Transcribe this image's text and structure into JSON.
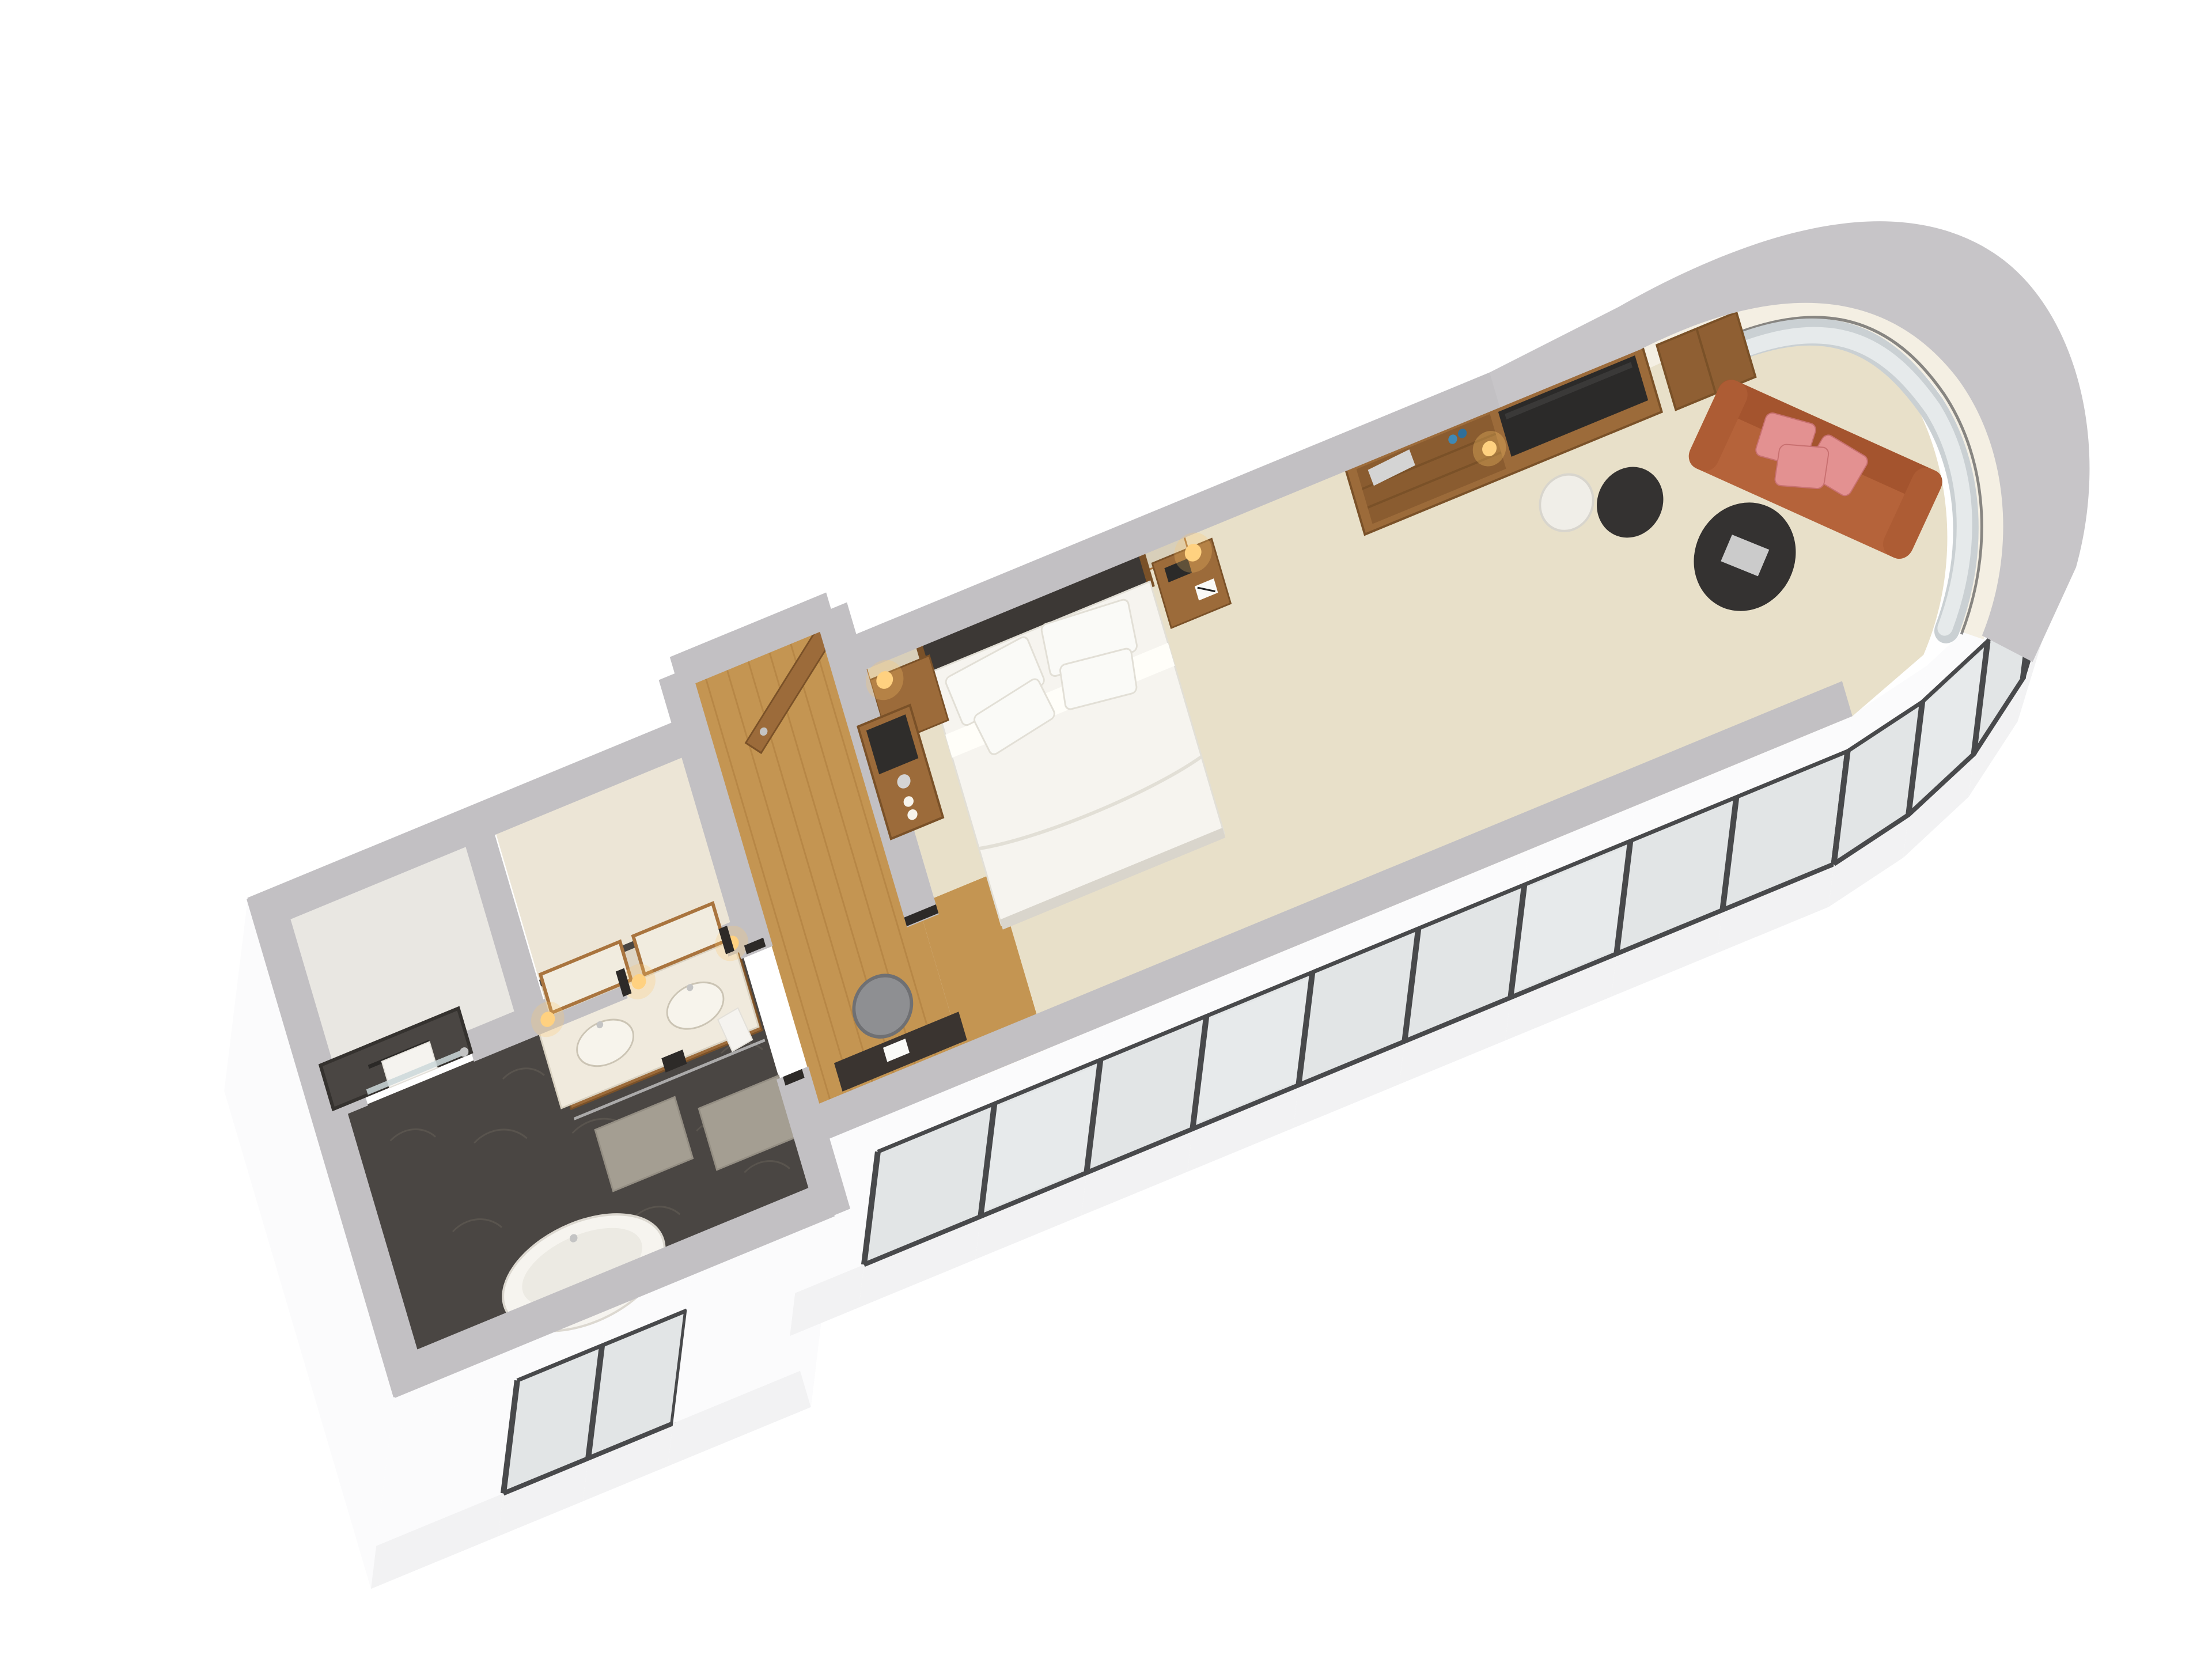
{
  "meta": {
    "type": "3d-floorplan-render",
    "view": "isometric-cutaway"
  },
  "colors": {
    "background": "#ffffff",
    "wall_cut_gray": "#c2c0c3",
    "wall_cut_gray_light": "#c7c5c8",
    "interior_wall_face": "#f4efe3",
    "facade_white": "#fbfbfc",
    "facade_shade": "#f2f2f3",
    "glass": "#e2e5e6",
    "glass_frame": "#48494b",
    "sheer_curtain": "#ebeeef",
    "drape_curtain": "#cad0d3",
    "curtain_rod": "#3e3e40",
    "carpet": "#e8e0c9",
    "wood_floor": "#c49552",
    "wood_plank_line": "#ad7c3e",
    "wood_furniture": "#9c6b3a",
    "wood_furniture_dark": "#7a5128",
    "wood_frame": "#a9743e",
    "tile_dark": "#4a4643",
    "tile_pattern": "#605a53",
    "shower_floor": "#e9e7e2",
    "toilet_floor": "#ece5d6",
    "beige_panel": "#ded5c4",
    "panel_trim_dark": "#4a4642",
    "marble": "#f0eadd",
    "sink_white": "#f7f4ec",
    "bed_white": "#f6f4ef",
    "pillow_white": "#fafaf7",
    "linen_shadow": "#e2dfd6",
    "headboard_dark": "#3c3835",
    "sofa_terracotta": "#b5633a",
    "sofa_terracotta_dark": "#a4542e",
    "pillow_pink": "#e39191",
    "pillow_pink_dark": "#c87070",
    "table_black": "#343231",
    "table_white": "#f0eee8",
    "tray_silver": "#d4d4d4",
    "lamp_glow": "#ffd180",
    "lamp_halo": "#ffc96a",
    "towel_white": "#f5f3ef",
    "mat_gray": "#a49e92",
    "chair_gray": "#8e8f92",
    "desk_dark": "#3a3430",
    "tv_black": "#2b2a29",
    "metal_silver": "#c4c4c4",
    "door_jamb_dark": "#2d2a28",
    "bottle_blue": "#3f89b5"
  },
  "scene_items": [
    "exterior-cut-walls",
    "window-facade",
    "curved-window-wall",
    "shower-room",
    "toilet-room",
    "bathroom",
    "double-vanity",
    "vanity-mirrors",
    "vanity-sconces",
    "bathtub",
    "bath-mats",
    "towel-rail",
    "entry-hall",
    "entry-door",
    "minibar-niche",
    "desk",
    "desk-chair",
    "bedroom",
    "double-bed",
    "bed-pillows",
    "headboard",
    "nightstand-left",
    "nightstand-right",
    "wall-lamps",
    "tv-media-unit",
    "shelf-minibar",
    "wardrobe",
    "lounge",
    "sofa",
    "sofa-throw-pillows",
    "coffee-table",
    "side-table",
    "pedestal-table",
    "curtains"
  ]
}
